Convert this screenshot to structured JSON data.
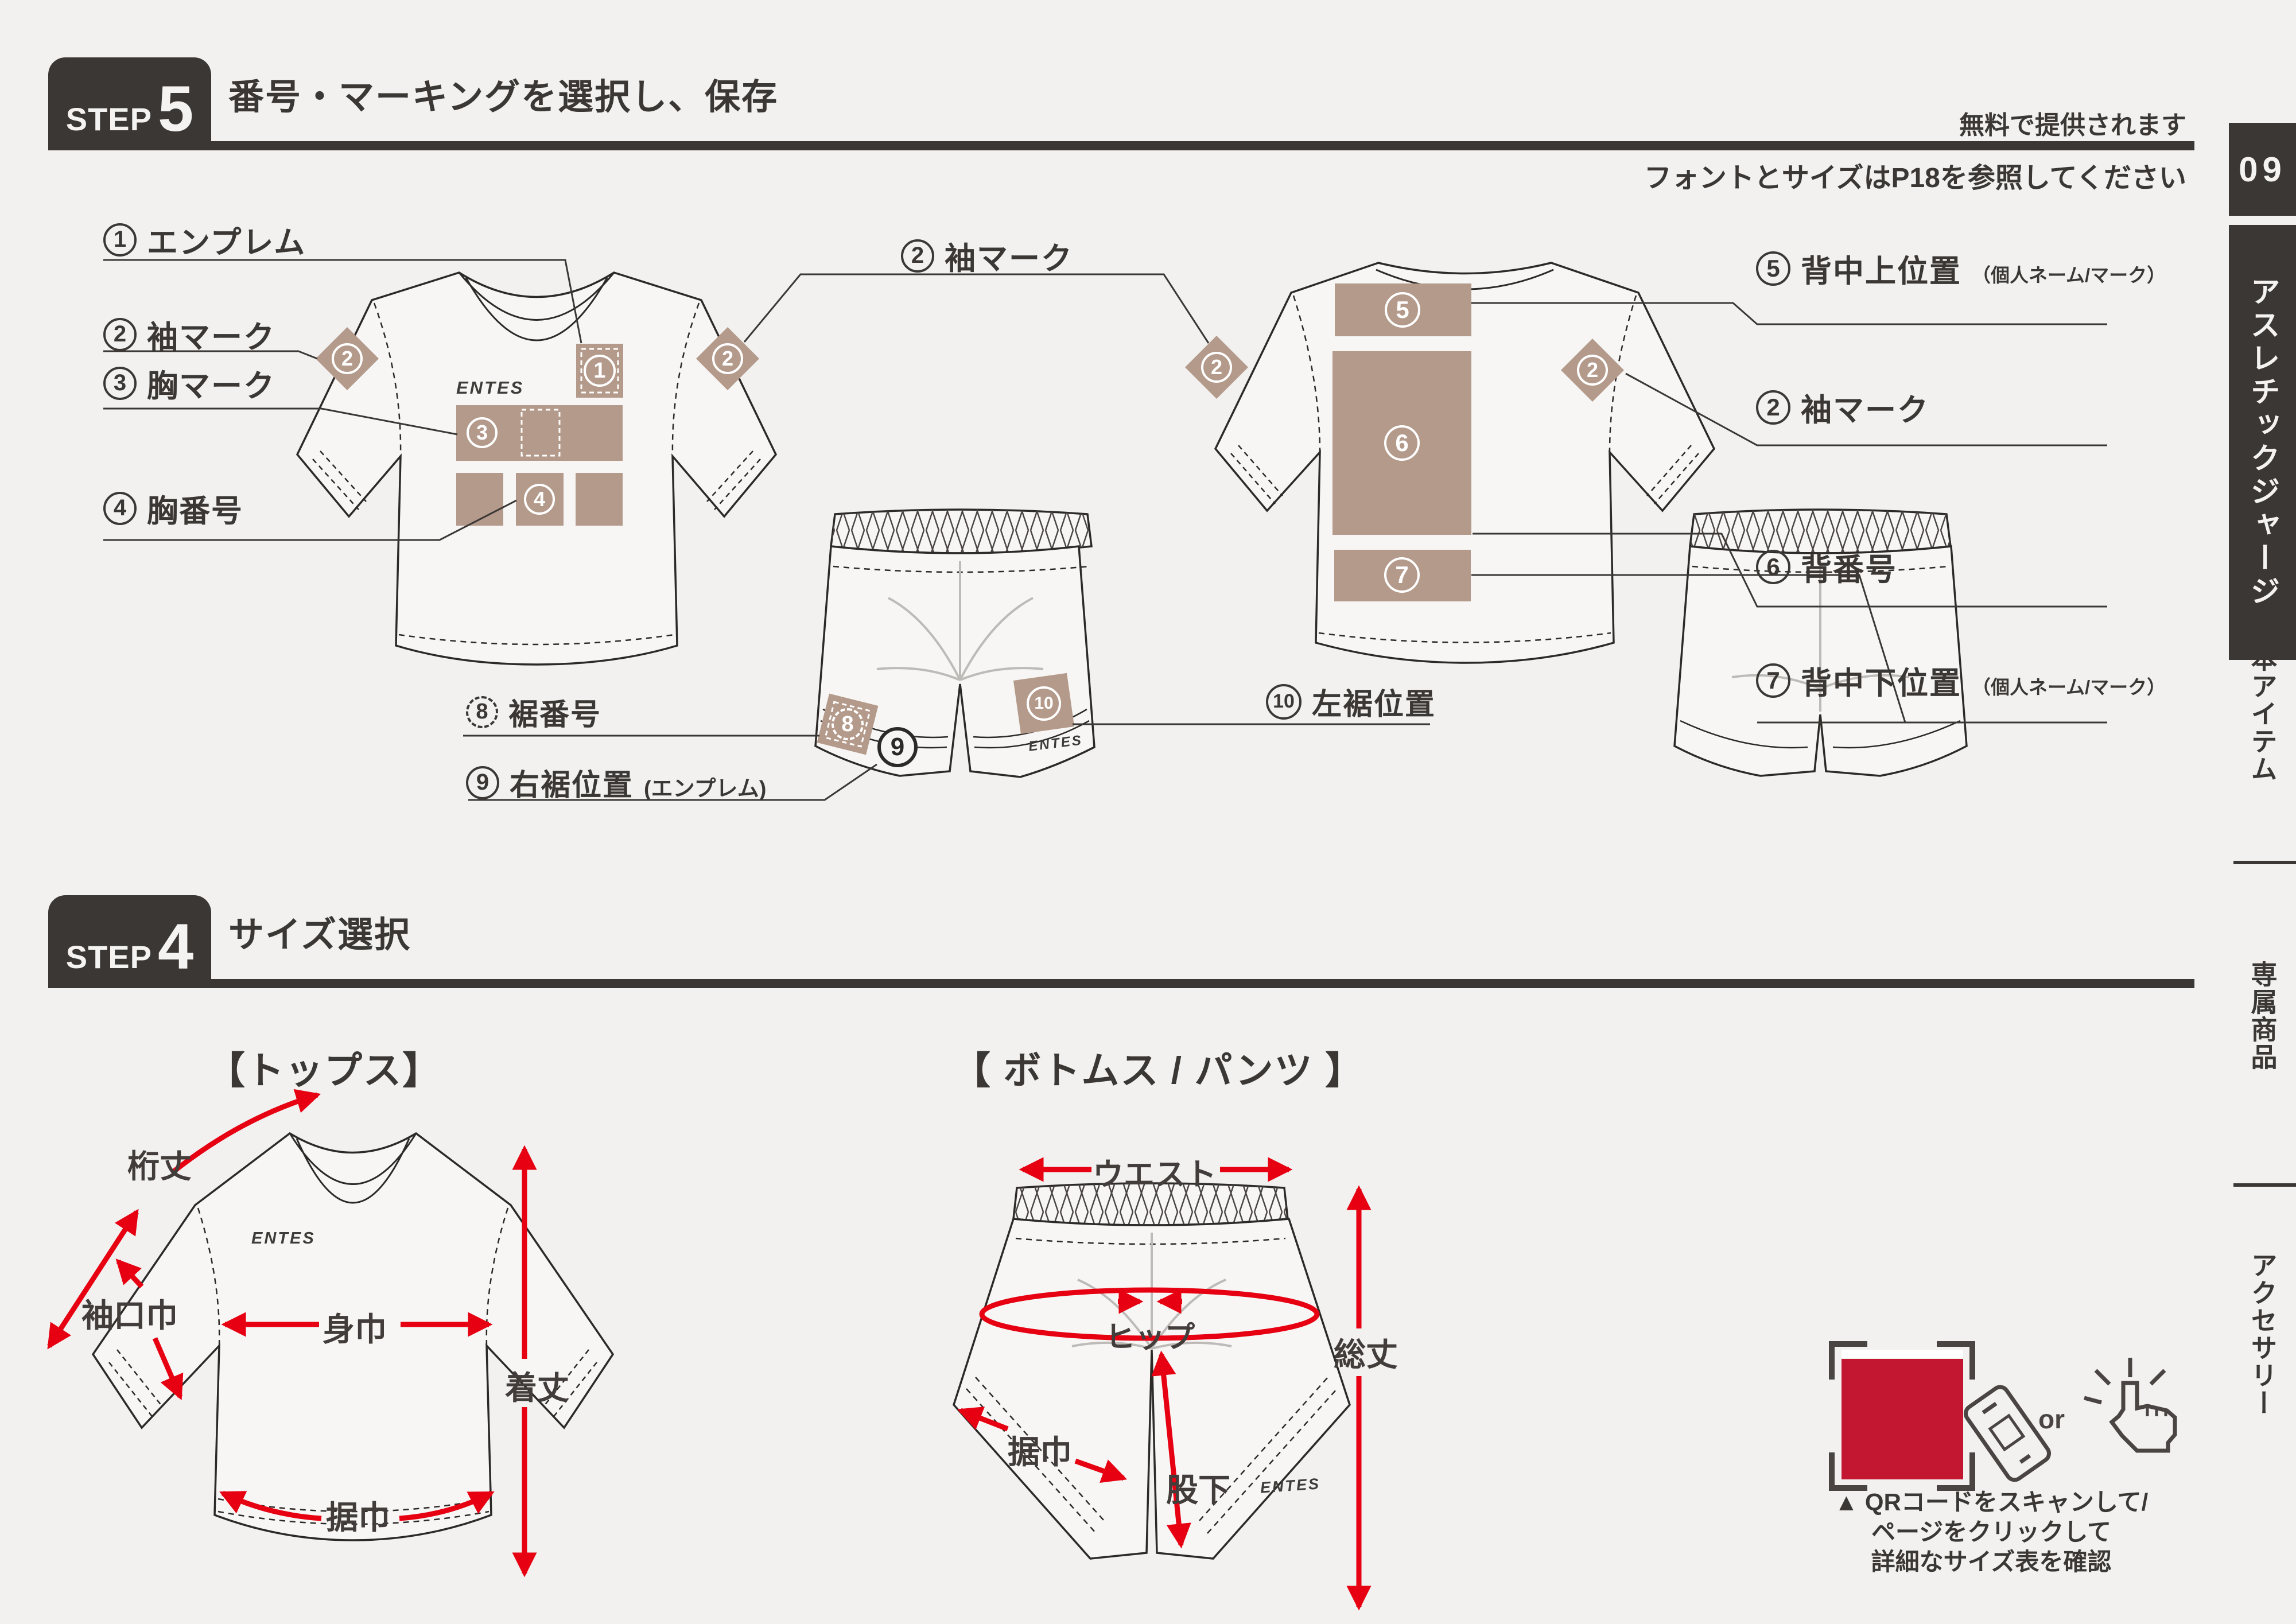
{
  "colors": {
    "bg": "#f2f1ef",
    "ink": "#3b3734",
    "tan": "#b49a8b",
    "red": "#e60012",
    "qr_red": "#c31631"
  },
  "header": {
    "step_word": "STEP",
    "step_num": "5",
    "title": "番号・マーキングを選択し、保存",
    "free_note": "無料で提供されます",
    "size_note_pre": "フォントとサイズは",
    "size_note_bold": "P18",
    "size_note_post": "を参照してください"
  },
  "sidebar": {
    "page_num": "09",
    "tab": "アスレチックジャージ",
    "item_basic": "基本アイテム",
    "item_exclusive": "専属商品",
    "item_accessory": "アクセサリー"
  },
  "brand": "ENTES",
  "marks": {
    "m1": "1",
    "m2": "2",
    "m3": "3",
    "m4": "4",
    "m5": "5",
    "m6": "6",
    "m7": "7",
    "m8": "8",
    "m9": "9",
    "m10": "10"
  },
  "labels": {
    "l1": {
      "num": "1",
      "text": "エンプレム"
    },
    "l2": {
      "num": "2",
      "text": "袖マーク"
    },
    "l3": {
      "num": "3",
      "text": "胸マーク"
    },
    "l4": {
      "num": "4",
      "text": "胸番号"
    },
    "c2": {
      "num": "2",
      "text": "袖マーク"
    },
    "r5": {
      "num": "5",
      "text": "背中上位置",
      "suffix": "（個人ネーム/マーク）"
    },
    "r2": {
      "num": "2",
      "text": "袖マーク"
    },
    "r6": {
      "num": "6",
      "text": "背番号"
    },
    "r7": {
      "num": "7",
      "text": "背中下位置",
      "suffix": "（個人ネーム/マーク）"
    },
    "b8": {
      "num": "8",
      "text": "裾番号"
    },
    "b9": {
      "num": "9",
      "text": "右裾位置",
      "suffix": "(エンプレム)"
    },
    "b10": {
      "num": "10",
      "text": "左裾位置"
    }
  },
  "step4": {
    "step_word": "STEP",
    "step_num": "4",
    "title": "サイズ選択",
    "tops_title": "【トップス】",
    "bottoms_title": "【 ボトムス / パンツ 】",
    "tops": {
      "sleeve": "桁丈",
      "cuff": "袖口巾",
      "chest": "身巾",
      "length": "着丈",
      "hem": "据巾"
    },
    "bottoms": {
      "waist": "ウエスト",
      "hip": "ヒップ",
      "total": "総丈",
      "inseam": "股下",
      "hem": "据巾"
    }
  },
  "qr": {
    "or_text": "or",
    "caption1": "▲ QRコードをスキャンして/",
    "caption2": "ページをクリックして",
    "caption3": "詳細なサイズ表を確認"
  }
}
